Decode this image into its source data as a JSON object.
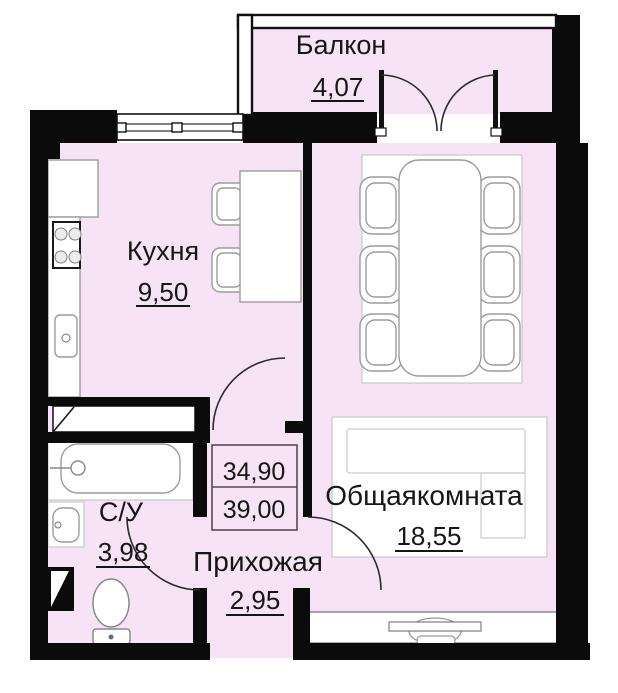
{
  "rooms": {
    "balcony": {
      "label": "Балкон",
      "area": "4,07"
    },
    "kitchen": {
      "label": "Кухня",
      "area": "9,50"
    },
    "living": {
      "label": "Общаякомната",
      "area": "18,55"
    },
    "bathroom": {
      "label": "С/У",
      "area": "3,98"
    },
    "hallway": {
      "label": "Прихожая",
      "area": "2,95"
    }
  },
  "area_box": {
    "living_total": "34,90",
    "overall_total": "39,00"
  },
  "colors": {
    "floor": "#f6e3f5",
    "wall": "#0b0b0b",
    "text": "#161616",
    "furniture-stroke": "#9c9c9c"
  }
}
